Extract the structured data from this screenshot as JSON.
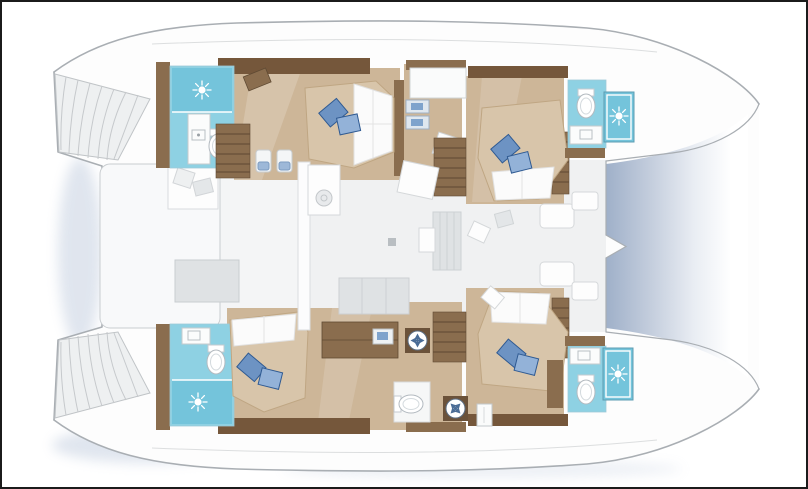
{
  "page": {
    "title": "",
    "visible_text": []
  },
  "colors": {
    "border": "#1b1b1b",
    "background": "#ffffff",
    "outline": "#a9aeb3",
    "deck_white": "#fdfdfd",
    "faded_floor": "#f0f1f2",
    "cockpit_floor": "#f4f5f6",
    "faded_furniture": "#dfe2e4",
    "faded_stroke": "#c9cdd0",
    "wood_dark": "#75573b",
    "wood_trim": "#8a6d4e",
    "wood_light": "#cdb698",
    "bath_cyan": "#8ed1e3",
    "shower_cyan": "#74c4db",
    "mattress": "#d8c5aa",
    "sheet_white": "#fbfbfb",
    "pillow_blue": "#6d93c3",
    "pillow_blue_light": "#93b2d8",
    "pillow_blue_dark": "#2f5a92",
    "trampoline_dark": "#9fb0c9",
    "shadow_blue": "#b9c6da",
    "appliance_blade": "#4a6c96"
  },
  "plan": {
    "type": "catamaran-floor-plan",
    "orientation": "bow-right",
    "hulls": [
      {
        "id": "port-hull",
        "areas": [
          {
            "id": "transom-steps-port",
            "kind": "swim-platform-steps"
          },
          {
            "id": "bathroom-port-aft",
            "kind": "bathroom",
            "features": [
              "shower",
              "sink",
              "toilet"
            ]
          },
          {
            "id": "cabin-port-aft",
            "kind": "double-cabin",
            "features": [
              "bed",
              "pillows",
              "stairs",
              "stools"
            ]
          },
          {
            "id": "nav-area-port",
            "kind": "desk-area",
            "features": [
              "desk",
              "drawers",
              "hatch"
            ]
          },
          {
            "id": "cabin-port-fwd",
            "kind": "double-cabin",
            "features": [
              "bed",
              "pillows",
              "stairs"
            ]
          },
          {
            "id": "bathroom-port-fwd",
            "kind": "bathroom",
            "features": [
              "toilet",
              "sink",
              "shower"
            ]
          }
        ]
      },
      {
        "id": "starboard-hull",
        "areas": [
          {
            "id": "transom-steps-starboard",
            "kind": "swim-platform-steps"
          },
          {
            "id": "bathroom-starboard-aft",
            "kind": "bathroom",
            "features": [
              "sink",
              "toilet",
              "shower"
            ]
          },
          {
            "id": "cabin-starboard-aft",
            "kind": "double-cabin",
            "features": [
              "bed",
              "pillows",
              "sideboard"
            ]
          },
          {
            "id": "utility-area-starboard",
            "kind": "utility",
            "features": [
              "washing-machine",
              "stairs",
              "toilet-room",
              "appliance",
              "door"
            ]
          },
          {
            "id": "cabin-starboard-fwd",
            "kind": "double-cabin",
            "features": [
              "bed",
              "pillows",
              "stairs"
            ]
          },
          {
            "id": "bathroom-starboard-fwd",
            "kind": "bathroom",
            "features": [
              "sink",
              "toilet",
              "shower"
            ]
          }
        ]
      }
    ],
    "bridgedeck": [
      {
        "id": "aft-deck",
        "kind": "cockpit",
        "features": [
          "sun-lounge",
          "cockpit-table"
        ]
      },
      {
        "id": "saloon",
        "kind": "saloon",
        "features": [
          "galley-island",
          "chart-table",
          "rug",
          "sofa",
          "forward-seats"
        ]
      },
      {
        "id": "trampoline",
        "kind": "trampoline-net"
      }
    ]
  }
}
